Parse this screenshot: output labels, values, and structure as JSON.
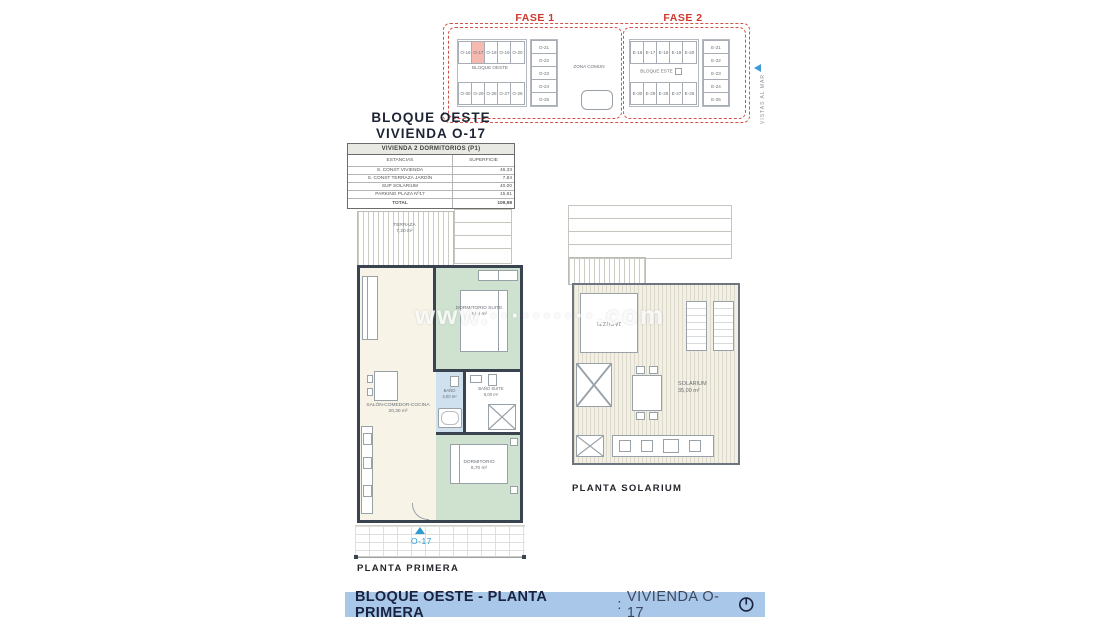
{
  "colors": {
    "fase_red": "#d0382c",
    "highlight_pink": "#f5b9b2",
    "unit_blue": "#2f9ad0",
    "wall_dark": "#3a4350",
    "room_green": "#cfe2d0",
    "room_cream": "#f7f3e6",
    "room_blue": "#cfe0ef",
    "footer_bg": "#a9c7e8",
    "footer_text": "#19233f"
  },
  "site_plan": {
    "fase1_label": "FASE 1",
    "fase2_label": "FASE 2",
    "zona_comun": "ZONA COMUN",
    "bloque_oeste": "BLOQUE OESTE",
    "bloque_este": "BLOQUE ESTE",
    "vistas_label": "VISTAS AL MAR",
    "fase1": {
      "highlighted_unit": "O-17",
      "top_units": [
        "O-16",
        "O-17",
        "O-18",
        "O-19",
        "O-20"
      ],
      "bottom_units": [
        "O-30",
        "O-29",
        "O-28",
        "O-27",
        "O-26"
      ],
      "right_units": [
        "O-21",
        "O-22",
        "O-23",
        "O-24",
        "O-25"
      ]
    },
    "fase2": {
      "top_units": [
        "E-16",
        "E-17",
        "E-18",
        "E-19",
        "E-20"
      ],
      "bottom_units": [
        "E-30",
        "E-29",
        "E-28",
        "E-27",
        "E-26"
      ],
      "right_units": [
        "E-21",
        "E-22",
        "E-23",
        "E-24",
        "E-25"
      ]
    }
  },
  "title_block": {
    "line1": "BLOQUE OESTE",
    "line2": "VIVIENDA O-17"
  },
  "surface_table": {
    "header": "VIVIENDA 2 DORMITORIOS (P1)",
    "col1": "ESTANCIAS",
    "col2": "SUPERFICIE",
    "rows": [
      {
        "name": "S. CONST VIVIENDA",
        "value": "46,33"
      },
      {
        "name": "S. CONST TERRAZA JARDÍN",
        "value": "7,84"
      },
      {
        "name": "SUP SOLARIUM",
        "value": "40,00"
      },
      {
        "name": "PARKING  PLAZA  Nº17",
        "value": "15,81"
      }
    ],
    "total_label": "TOTAL",
    "total_value": "109,98"
  },
  "floor_plan": {
    "terraza": {
      "name": "TERRAZA",
      "area": "7,20 m²"
    },
    "salon": {
      "name": "SALÓN-COMEDOR-COCINA",
      "area": "20,30 m²"
    },
    "dormitorio_suite": {
      "name": "DORMITORIO SUITE",
      "area": "9,60 m²"
    },
    "bano": {
      "name": "BAÑO",
      "area": "3,00 m²"
    },
    "bano_suite": {
      "name": "BAÑO SUITE",
      "area": "5,00 m²"
    },
    "dormitorio": {
      "name": "DORMITORIO",
      "area": "6,70 m²"
    },
    "unit_badge": "O-17",
    "caption": "PLANTA PRIMERA"
  },
  "solarium_plan": {
    "jacuzzi": "JACUZZI",
    "solarium_name": "SOLARIUM",
    "solarium_area": "35,00 m²",
    "caption": "PLANTA SOLARIUM"
  },
  "watermark": "www.··········.com",
  "footer": {
    "title_bold": "BLOQUE OESTE - PLANTA PRIMERA",
    "separator": ":",
    "title_regular": "VIVIENDA O-17"
  }
}
